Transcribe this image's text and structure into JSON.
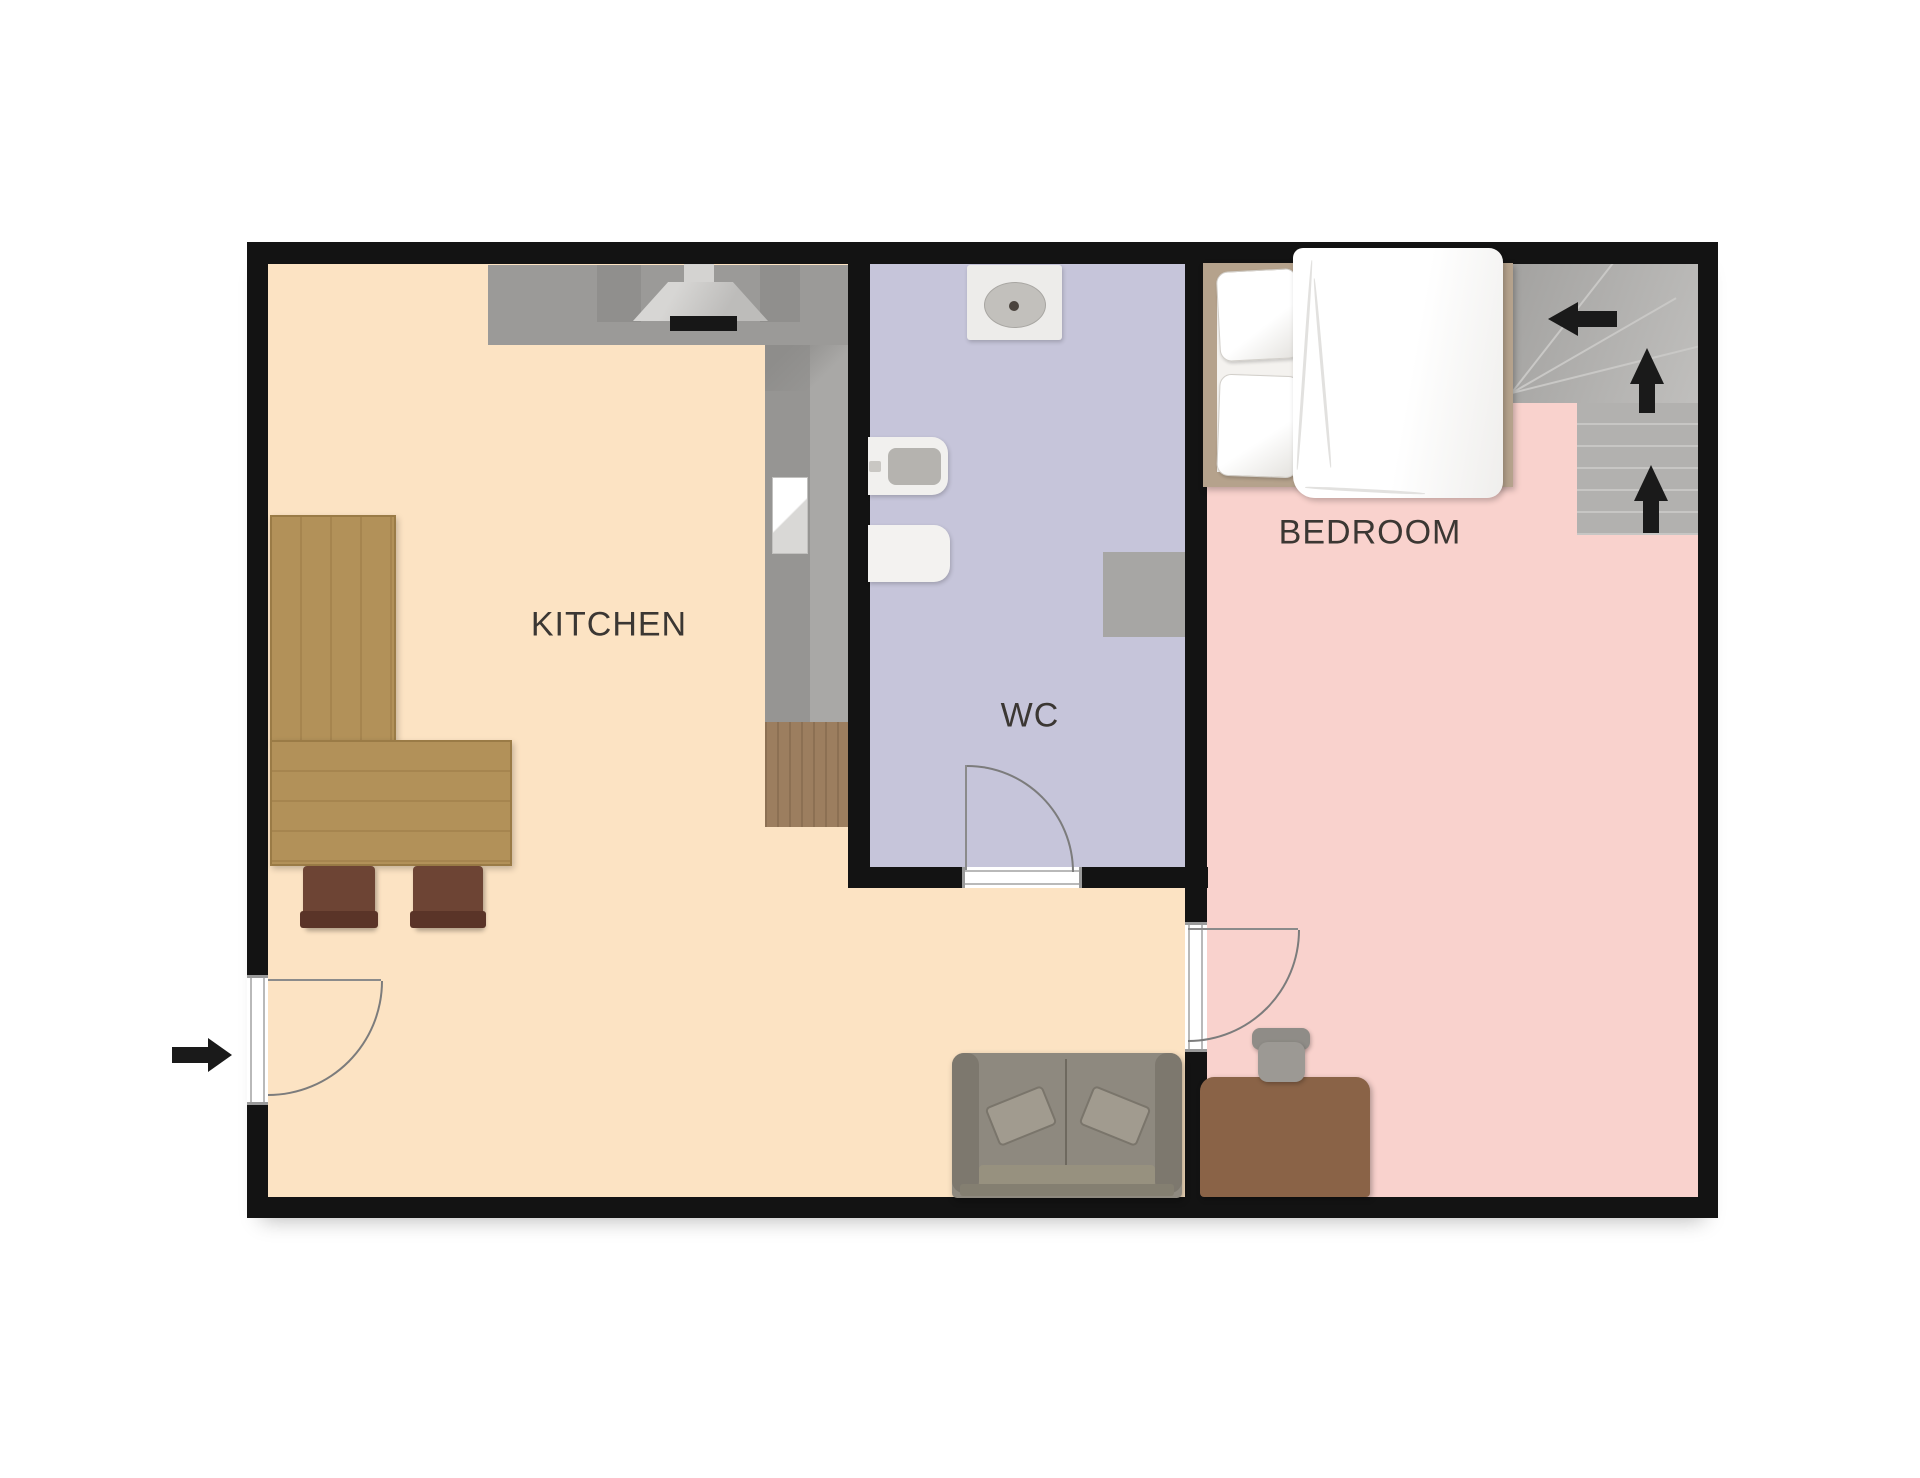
{
  "image_type": "floor-plan",
  "background": "#ffffff",
  "rooms": [
    {
      "id": "kitchen",
      "label": "KITCHEN",
      "floor_color": "#fce3c3"
    },
    {
      "id": "wc",
      "label": "WC",
      "floor_color": "#c6c5da"
    },
    {
      "id": "bedroom",
      "label": "BEDROOM",
      "floor_color": "#f9d2cd"
    }
  ],
  "walls": {
    "color": "#131313",
    "thickness_px": 21
  },
  "label_style": {
    "color": "#3b3733",
    "font_size_px": 34
  },
  "doors": [
    {
      "id": "entry-door",
      "location": "left-exterior-wall",
      "swings": "into-kitchen"
    },
    {
      "id": "wc-door",
      "location": "wc-bottom-wall",
      "swings": "into-wc"
    },
    {
      "id": "bedroom-door",
      "location": "kitchen-bedroom-wall",
      "swings": "into-bedroom"
    }
  ],
  "entry_arrow": {
    "direction": "right",
    "color": "#1a1a1a"
  },
  "stairs": {
    "location": "bedroom-top-right-corner",
    "base_color": "#b2b1af",
    "tread_line_color": "#c7c6c4",
    "direction_arrows": [
      "left",
      "up",
      "up"
    ]
  },
  "furniture": {
    "kitchen": [
      {
        "id": "l-shaped-counter",
        "color": "#9b9a98"
      },
      {
        "id": "range-hood",
        "body_color": "#cfcecb",
        "bar_color": "#171717"
      },
      {
        "id": "counter-sink",
        "color": "#ffffff"
      },
      {
        "id": "wood-cabinet",
        "color": "#9c7e5f"
      },
      {
        "id": "dining-table",
        "color": "#b29159"
      },
      {
        "id": "dining-chair",
        "color": "#6d4434",
        "count": 2
      },
      {
        "id": "sofa",
        "color": "#8e897f"
      }
    ],
    "wc": [
      {
        "id": "toilet",
        "color": "#edecea"
      },
      {
        "id": "wash-basin",
        "color": "#f1f0ee"
      },
      {
        "id": "bidet",
        "color": "#f3f2f0"
      },
      {
        "id": "washing-machine",
        "color": "#a7a6a4"
      }
    ],
    "bedroom": [
      {
        "id": "double-bed",
        "frame_color": "#b5a28c",
        "bedding_color": "#ffffff",
        "pillows": 2
      },
      {
        "id": "desk",
        "color": "#8a6347"
      },
      {
        "id": "office-chair",
        "color": "#96938e"
      }
    ]
  }
}
